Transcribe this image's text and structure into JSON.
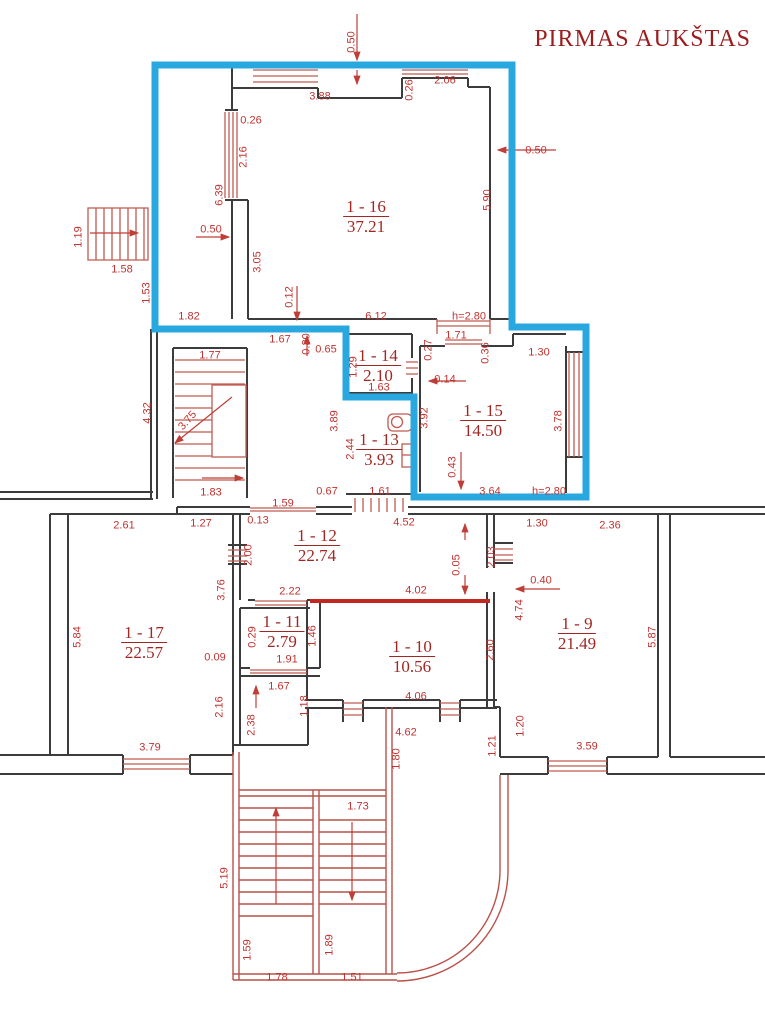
{
  "title": "PIRMAS AUKŠTAS",
  "colors": {
    "wall": "#3c3c3c",
    "blue_outline": "#29a8e0",
    "red_line": "#bf3f38",
    "red_thick": "#c22822",
    "dim_text": "#bf3330",
    "room_text": "#a02723",
    "title_text": "#9c1d1d"
  },
  "rooms": [
    {
      "id": "1 - 16",
      "area": "37.21",
      "x": 366,
      "y": 217
    },
    {
      "id": "1 - 14",
      "area": "2.10",
      "x": 378,
      "y": 366
    },
    {
      "id": "1 - 13",
      "area": "3.93",
      "x": 379,
      "y": 450
    },
    {
      "id": "1 - 15",
      "area": "14.50",
      "x": 483,
      "y": 421
    },
    {
      "id": "1 - 12",
      "area": "22.74",
      "x": 317,
      "y": 546
    },
    {
      "id": "1 - 17",
      "area": "22.57",
      "x": 144,
      "y": 643
    },
    {
      "id": "1 - 11",
      "area": "2.79",
      "x": 282,
      "y": 632
    },
    {
      "id": "1 - 10",
      "area": "10.56",
      "x": 412,
      "y": 657
    },
    {
      "id": "1 - 9",
      "area": "21.49",
      "x": 577,
      "y": 634
    }
  ],
  "dimensions": [
    {
      "t": "0.50",
      "x": 352,
      "y": 42,
      "v": true
    },
    {
      "t": "3.88",
      "x": 320,
      "y": 97
    },
    {
      "t": "0.26",
      "x": 410,
      "y": 90,
      "v": true
    },
    {
      "t": "2.06",
      "x": 445,
      "y": 81
    },
    {
      "t": "0.50",
      "x": 536,
      "y": 151
    },
    {
      "t": "5.90",
      "x": 488,
      "y": 200,
      "v": true
    },
    {
      "t": "0.26",
      "x": 251,
      "y": 121
    },
    {
      "t": "2.16",
      "x": 244,
      "y": 157,
      "v": true
    },
    {
      "t": "6.39",
      "x": 220,
      "y": 195,
      "v": true
    },
    {
      "t": "0.50",
      "x": 211,
      "y": 230
    },
    {
      "t": "1.19",
      "x": 79,
      "y": 237,
      "v": true
    },
    {
      "t": "1.58",
      "x": 122,
      "y": 270
    },
    {
      "t": "1.53",
      "x": 147,
      "y": 293,
      "v": true
    },
    {
      "t": "3.05",
      "x": 258,
      "y": 262,
      "v": true
    },
    {
      "t": "0.12",
      "x": 290,
      "y": 297,
      "v": true
    },
    {
      "t": "1.82",
      "x": 189,
      "y": 317
    },
    {
      "t": "6.12",
      "x": 376,
      "y": 317
    },
    {
      "t": "h=2.80",
      "x": 469,
      "y": 317
    },
    {
      "t": "1.71",
      "x": 456,
      "y": 336
    },
    {
      "t": "0.27",
      "x": 429,
      "y": 350,
      "v": true
    },
    {
      "t": "0.36",
      "x": 486,
      "y": 353,
      "v": true
    },
    {
      "t": "1.30",
      "x": 539,
      "y": 353
    },
    {
      "t": "1.67",
      "x": 280,
      "y": 340
    },
    {
      "t": "0.30",
      "x": 307,
      "y": 344,
      "v": true
    },
    {
      "t": "0.65",
      "x": 326,
      "y": 350
    },
    {
      "t": "1.77",
      "x": 210,
      "y": 356
    },
    {
      "t": "4.32",
      "x": 148,
      "y": 413,
      "v": true
    },
    {
      "t": "3.75",
      "x": 188,
      "y": 421,
      "rot": -48
    },
    {
      "t": "1.29",
      "x": 354,
      "y": 367,
      "v": true
    },
    {
      "t": "1.63",
      "x": 379,
      "y": 388
    },
    {
      "t": "0.14",
      "x": 445,
      "y": 380
    },
    {
      "t": "3.89",
      "x": 335,
      "y": 421,
      "v": true
    },
    {
      "t": "2.44",
      "x": 351,
      "y": 449,
      "v": true
    },
    {
      "t": "3.92",
      "x": 425,
      "y": 418,
      "v": true
    },
    {
      "t": "3.78",
      "x": 559,
      "y": 421,
      "v": true
    },
    {
      "t": "0.43",
      "x": 453,
      "y": 467,
      "v": true
    },
    {
      "t": "1.61",
      "x": 380,
      "y": 492
    },
    {
      "t": "0.67",
      "x": 327,
      "y": 492
    },
    {
      "t": "3.64",
      "x": 490,
      "y": 492
    },
    {
      "t": "h=2.80",
      "x": 549,
      "y": 492
    },
    {
      "t": "1.83",
      "x": 211,
      "y": 493
    },
    {
      "t": "1.59",
      "x": 283,
      "y": 504
    },
    {
      "t": "0.13",
      "x": 258,
      "y": 521
    },
    {
      "t": "4.52",
      "x": 404,
      "y": 523
    },
    {
      "t": "1.30",
      "x": 537,
      "y": 524
    },
    {
      "t": "2.36",
      "x": 610,
      "y": 526
    },
    {
      "t": "2.61",
      "x": 124,
      "y": 526
    },
    {
      "t": "1.27",
      "x": 201,
      "y": 524
    },
    {
      "t": "2.03",
      "x": 492,
      "y": 557,
      "v": true
    },
    {
      "t": "2.00",
      "x": 249,
      "y": 555,
      "v": true
    },
    {
      "t": "0.40",
      "x": 541,
      "y": 581
    },
    {
      "t": "0.05",
      "x": 457,
      "y": 565,
      "v": true
    },
    {
      "t": "2.22",
      "x": 290,
      "y": 592
    },
    {
      "t": "4.02",
      "x": 416,
      "y": 591
    },
    {
      "t": "4.74",
      "x": 520,
      "y": 610,
      "v": true
    },
    {
      "t": "5.84",
      "x": 78,
      "y": 637,
      "v": true
    },
    {
      "t": "3.76",
      "x": 222,
      "y": 590,
      "v": true
    },
    {
      "t": "0.09",
      "x": 215,
      "y": 658
    },
    {
      "t": "0.29",
      "x": 253,
      "y": 637,
      "v": true
    },
    {
      "t": "1.46",
      "x": 313,
      "y": 636,
      "v": true
    },
    {
      "t": "1.91",
      "x": 287,
      "y": 660
    },
    {
      "t": "2.60",
      "x": 491,
      "y": 650,
      "v": true
    },
    {
      "t": "5.87",
      "x": 653,
      "y": 637,
      "v": true
    },
    {
      "t": "2.16",
      "x": 220,
      "y": 707,
      "v": true
    },
    {
      "t": "1.67",
      "x": 279,
      "y": 687
    },
    {
      "t": "1.18",
      "x": 305,
      "y": 706,
      "v": true
    },
    {
      "t": "2.38",
      "x": 252,
      "y": 725,
      "v": true
    },
    {
      "t": "4.06",
      "x": 416,
      "y": 697
    },
    {
      "t": "1.20",
      "x": 521,
      "y": 726,
      "v": true
    },
    {
      "t": "1.21",
      "x": 493,
      "y": 746,
      "v": true
    },
    {
      "t": "3.79",
      "x": 150,
      "y": 748
    },
    {
      "t": "3.59",
      "x": 587,
      "y": 747
    },
    {
      "t": "4.62",
      "x": 406,
      "y": 733
    },
    {
      "t": "1.80",
      "x": 397,
      "y": 759,
      "v": true
    },
    {
      "t": "1.73",
      "x": 358,
      "y": 807
    },
    {
      "t": "5.19",
      "x": 225,
      "y": 878,
      "v": true
    },
    {
      "t": "1.59",
      "x": 248,
      "y": 950,
      "v": true
    },
    {
      "t": "1.78",
      "x": 277,
      "y": 978
    },
    {
      "t": "1.89",
      "x": 330,
      "y": 945,
      "v": true
    },
    {
      "t": "1.51",
      "x": 352,
      "y": 978
    }
  ]
}
